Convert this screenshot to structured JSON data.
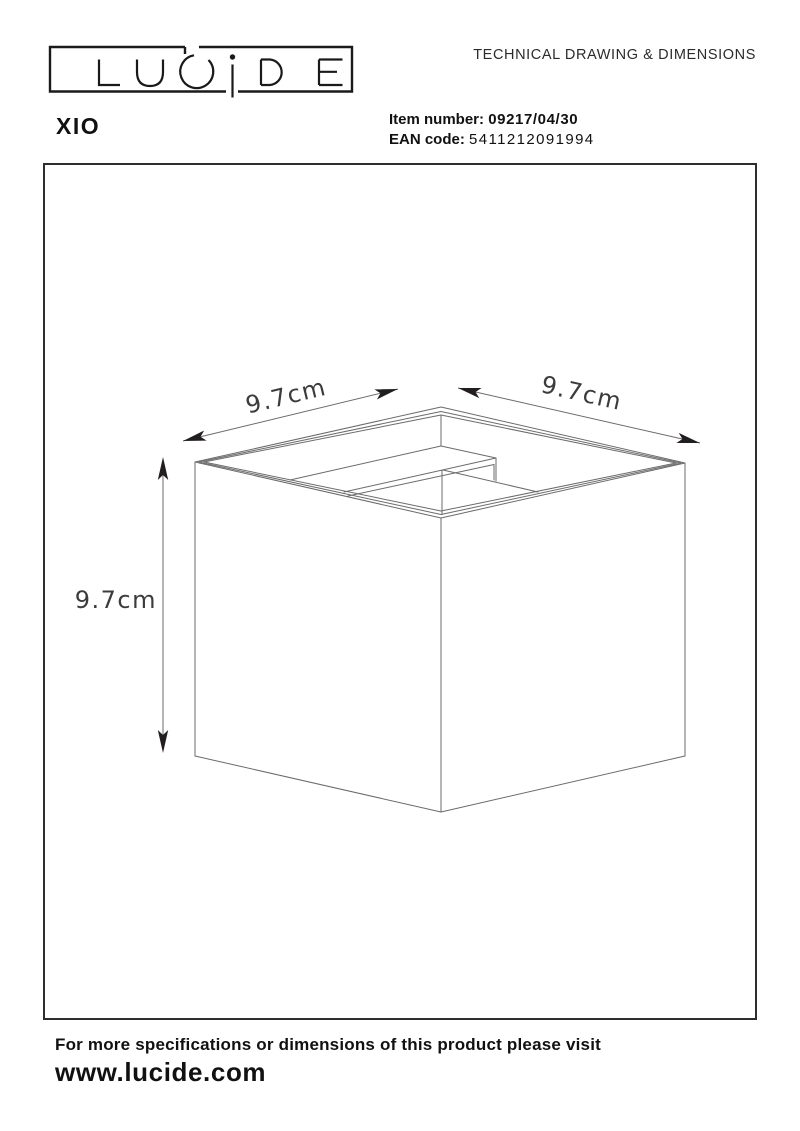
{
  "header": {
    "logo_text": "LUCIDE",
    "doc_title": "TECHNICAL DRAWING & DIMENSIONS",
    "product_name": "XIO",
    "item_number_label": "Item number:",
    "item_number_value": "09217/04/30",
    "ean_label": "EAN code:",
    "ean_value": "5411212091994"
  },
  "drawing": {
    "type": "isometric-cube-technical-drawing",
    "dim_width_left": "9.7cm",
    "dim_width_right": "9.7cm",
    "dim_height": "9.7cm",
    "dimensions_cm": {
      "width": 9.7,
      "depth": 9.7,
      "height": 9.7
    }
  },
  "footer": {
    "note": "For more specifications or dimensions of this product please visit",
    "website": "www.lucide.com"
  },
  "colors": {
    "ink": "#1a1a1a",
    "drawing_line": "#6b6b6b",
    "dimension_text": "#3c3c3c",
    "arrow": "#231e1e",
    "background": "#ffffff"
  }
}
